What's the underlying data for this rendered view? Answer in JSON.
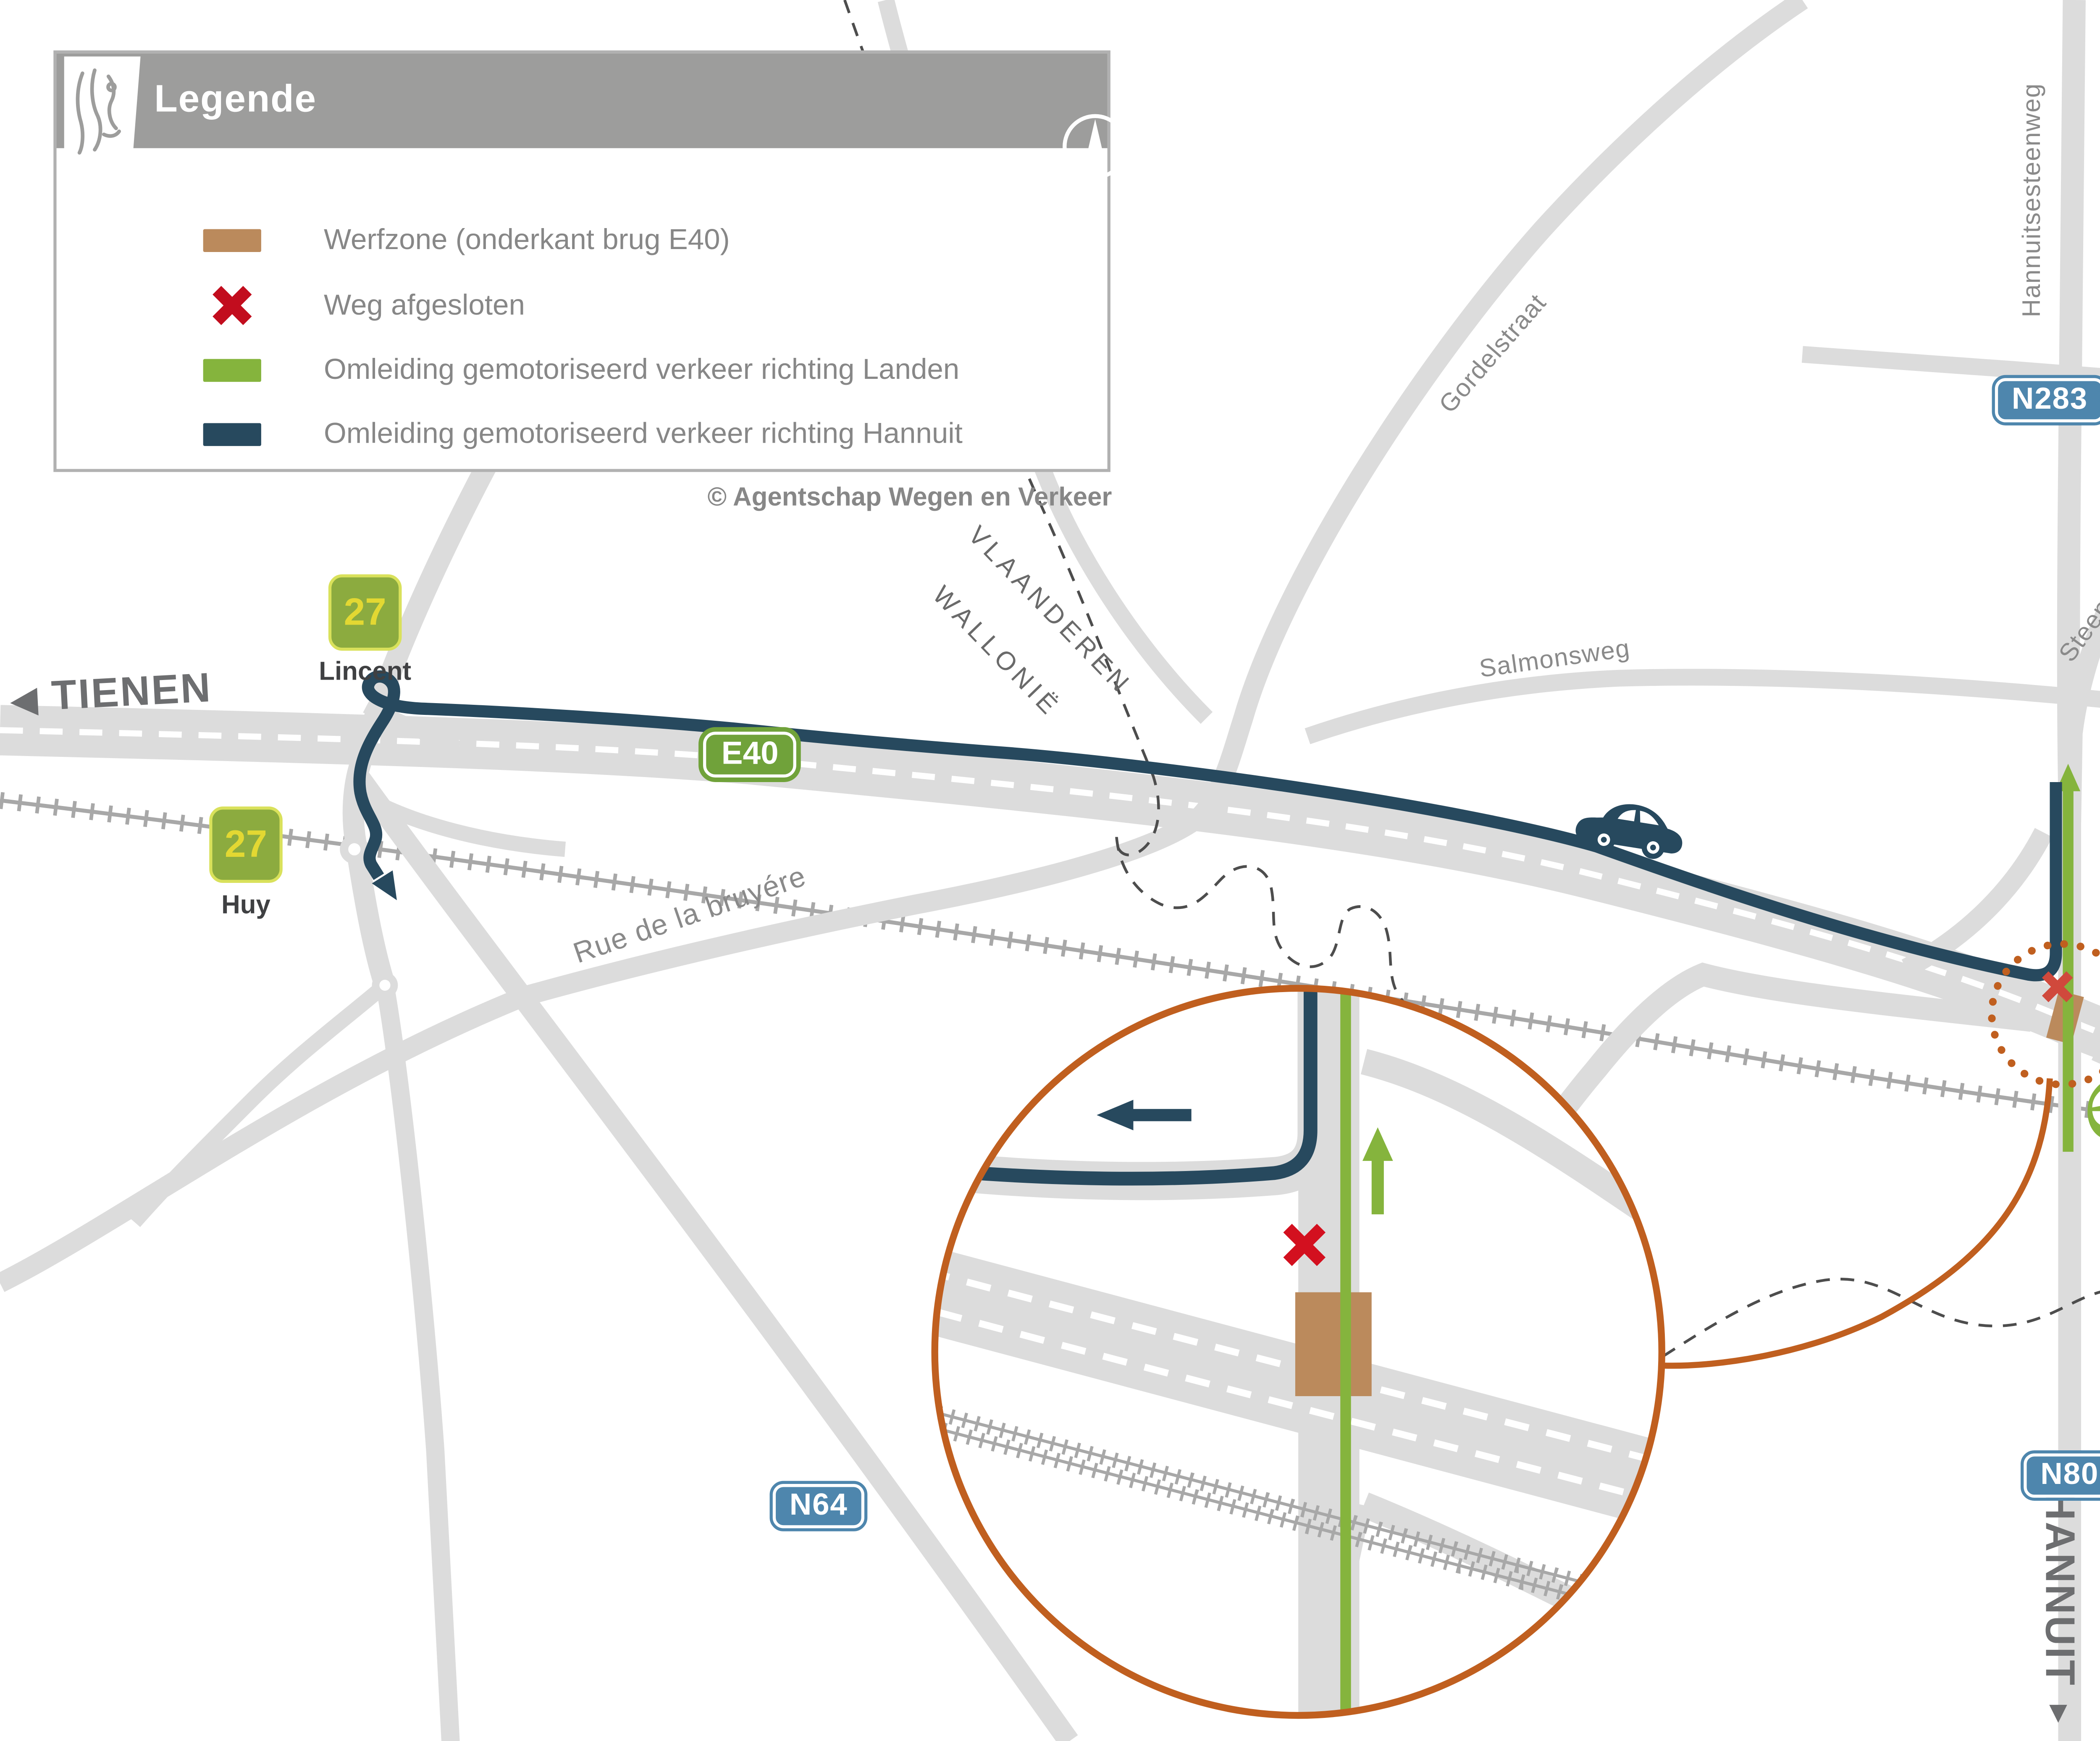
{
  "legend": {
    "title": "Legende",
    "compass_letter": "N",
    "items": [
      {
        "label": "Werfzone (onderkant brug E40)",
        "swatch": "werfzone"
      },
      {
        "label": "Weg afgesloten",
        "swatch": "road-closed"
      },
      {
        "label": "Omleiding gemotoriseerd verkeer richting Landen",
        "swatch": "detour-landen"
      },
      {
        "label": "Omleiding gemotoriseerd verkeer richting Hannuit",
        "swatch": "detour-hannuit"
      }
    ]
  },
  "copyright": "© Agentschap Wegen en Verkeer",
  "directions": {
    "west": {
      "label": "TIENEN",
      "icon": "◀"
    },
    "north": {
      "label": "LANDEN",
      "icon": "▲"
    },
    "east": {
      "label": "LUIK",
      "icon": "▶"
    },
    "south": {
      "label": "HANNUIT",
      "icon": "▼"
    }
  },
  "exits": {
    "lincent": {
      "number": "27",
      "name": "Lincent"
    },
    "huy": {
      "number": "27",
      "name": "Huy"
    },
    "landen": {
      "number": "28",
      "name": "Landen"
    }
  },
  "road_numbers": {
    "e40": "E40",
    "n283": "N283",
    "n80": "N80",
    "n64": "N64"
  },
  "streets": {
    "hannuitsesteenweg": "Hannuitsesteenweg",
    "steenweg_sint_truiden": "Steenweg op Sint-Truiden",
    "gordelstraat": "Gordelstraat",
    "salmonsweg": "Salmonsweg",
    "rue_de_la_bruyere": "Rue de la bruyére"
  },
  "boundary": {
    "north": "VLAANDEREN",
    "south": "WALLONIË"
  },
  "colors": {
    "road": "#dcdcdc",
    "railway": "#a8a8a8",
    "detour_hannuit": "#27495e",
    "detour_landen": "#85b43d",
    "werfzone": "#bb8a5c",
    "closed_x_legend": "#c20d1e",
    "closed_x_map": "#d0493c",
    "magnifier_orange": "#c05f1f",
    "legend_header": "#9d9d9c",
    "badge_blue": "#4e86ad",
    "badge_green": "#70a23a",
    "exit_badge": "#8cab3f",
    "exit_number": "#e3d832"
  }
}
